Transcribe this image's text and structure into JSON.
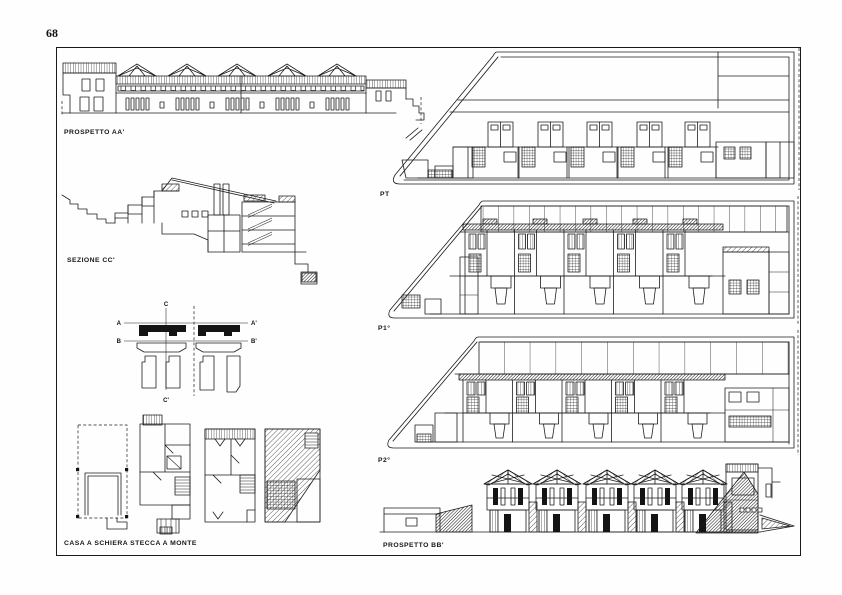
{
  "page": {
    "number": "68",
    "background": "#ffffff",
    "ink": "#1a1a1a"
  },
  "figures": {
    "prospetto_aa": {
      "label": "PROSPETTO AA'"
    },
    "sezione_cc": {
      "label": "SEZIONE CC'"
    },
    "key_plan": {
      "markers": {
        "a": "A",
        "a_prime": "A'",
        "b": "B",
        "b_prime": "B'",
        "c": "C",
        "c_prime": "C'"
      }
    },
    "casa_schiera": {
      "label": "CASA A SCHIERA STECCA A MONTE"
    },
    "pt": {
      "label": "PT"
    },
    "p1": {
      "label": "P1°"
    },
    "p2": {
      "label": "P2°"
    },
    "prospetto_bb": {
      "label": "PROSPETTO BB'"
    }
  }
}
